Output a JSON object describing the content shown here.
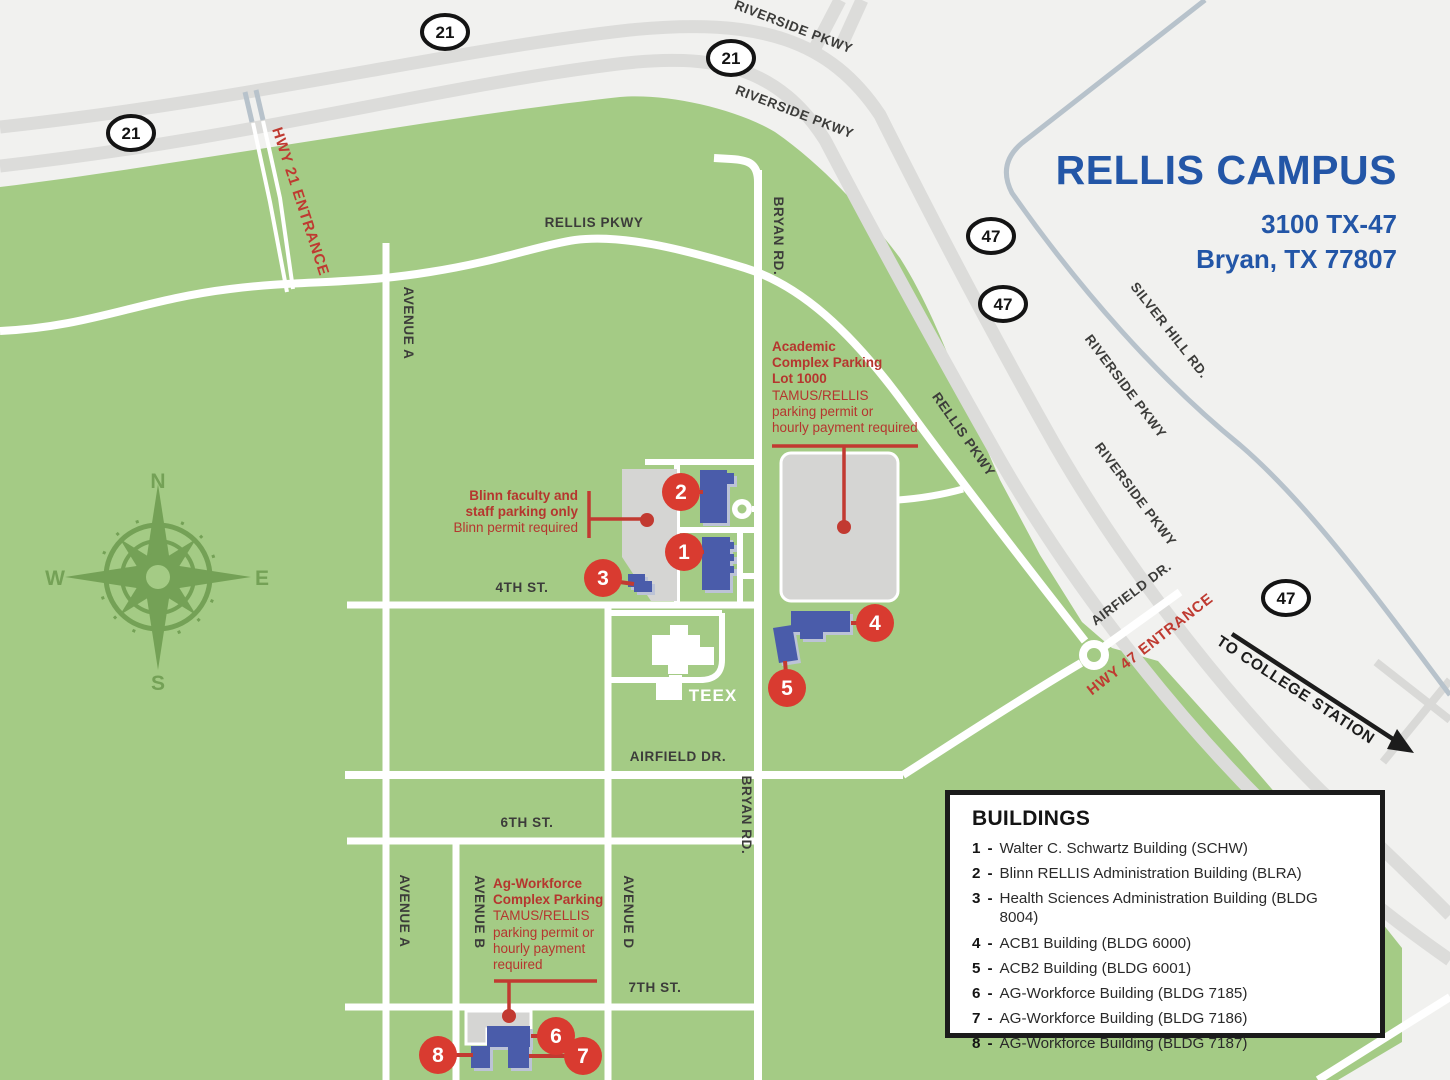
{
  "title": {
    "name": "RELLIS CAMPUS",
    "address1": "3100 TX-47",
    "address2": "Bryan, TX 77807"
  },
  "legend": {
    "heading": "BUILDINGS",
    "separator": "-",
    "items": [
      {
        "num": "1",
        "label": "Walter C. Schwartz Building (SCHW)"
      },
      {
        "num": "2",
        "label": "Blinn RELLIS Administration Building (BLRA)"
      },
      {
        "num": "3",
        "label": "Health Sciences Administration Building (BLDG 8004)"
      },
      {
        "num": "4",
        "label": "ACB1 Building (BLDG 6000)"
      },
      {
        "num": "5",
        "label": "ACB2 Building (BLDG 6001)"
      },
      {
        "num": "6",
        "label": "AG-Workforce Building (BLDG 7185)"
      },
      {
        "num": "7",
        "label": "AG-Workforce Building (BLDG 7186)"
      },
      {
        "num": "8",
        "label": "AG-Workforce Building (BLDG 7187)"
      }
    ]
  },
  "markers": [
    {
      "num": "1"
    },
    {
      "num": "2"
    },
    {
      "num": "3"
    },
    {
      "num": "4"
    },
    {
      "num": "5"
    },
    {
      "num": "6"
    },
    {
      "num": "7"
    },
    {
      "num": "8"
    }
  ],
  "shields": [
    {
      "num": "21"
    },
    {
      "num": "21"
    },
    {
      "num": "21"
    },
    {
      "num": "47"
    },
    {
      "num": "47"
    },
    {
      "num": "47"
    }
  ],
  "roads": [
    {
      "text": "RIVERSIDE PKWY"
    },
    {
      "text": "RIVERSIDE PKWY"
    },
    {
      "text": "RIVERSIDE PKWY"
    },
    {
      "text": "RIVERSIDE PKWY"
    },
    {
      "text": "SILVER HILL RD."
    },
    {
      "text": "RELLIS PKWY"
    },
    {
      "text": "RELLIS PKWY"
    },
    {
      "text": "BRYAN RD."
    },
    {
      "text": "BRYAN RD."
    },
    {
      "text": "AVENUE A"
    },
    {
      "text": "AVENUE A"
    },
    {
      "text": "AVENUE B"
    },
    {
      "text": "AVENUE D"
    },
    {
      "text": "4TH ST."
    },
    {
      "text": "6TH ST."
    },
    {
      "text": "AIRFIELD DR."
    },
    {
      "text": "AIRFIELD DR."
    },
    {
      "text": "7TH ST."
    }
  ],
  "teex_label": "TEEX",
  "callouts": {
    "academic": {
      "bold1": "Academic",
      "bold2": "Complex Parking",
      "bold3": "Lot 1000",
      "reg1": "TAMUS/RELLIS",
      "reg2": "parking permit or",
      "reg3": "hourly payment required"
    },
    "blinn": {
      "bold1": "Blinn faculty and",
      "bold2": "staff parking only",
      "reg1": "Blinn permit required"
    },
    "ag": {
      "bold1": "Ag-Workforce",
      "bold2": "Complex Parking",
      "reg1": "TAMUS/RELLIS",
      "reg2": "parking permit or",
      "reg3": "hourly payment",
      "reg4": "required"
    }
  },
  "entrances": {
    "hwy21": "HWY 21 ENTRANCE",
    "hwy47": "HWY 47 ENTRANCE"
  },
  "direction": {
    "to_college_station": "TO COLLEGE STATION"
  },
  "compass": {
    "n": "N",
    "e": "E",
    "s": "S",
    "w": "W"
  },
  "colors": {
    "campus_green": "#a4cb85",
    "compass_green": "#74a156",
    "highway_gray": "#dcdcda",
    "parking_gray": "#d5d5d3",
    "building_blue": "#4a5caa",
    "marker_red": "#d93b30",
    "callout_red": "#b5362e",
    "title_blue": "#2356a7"
  }
}
